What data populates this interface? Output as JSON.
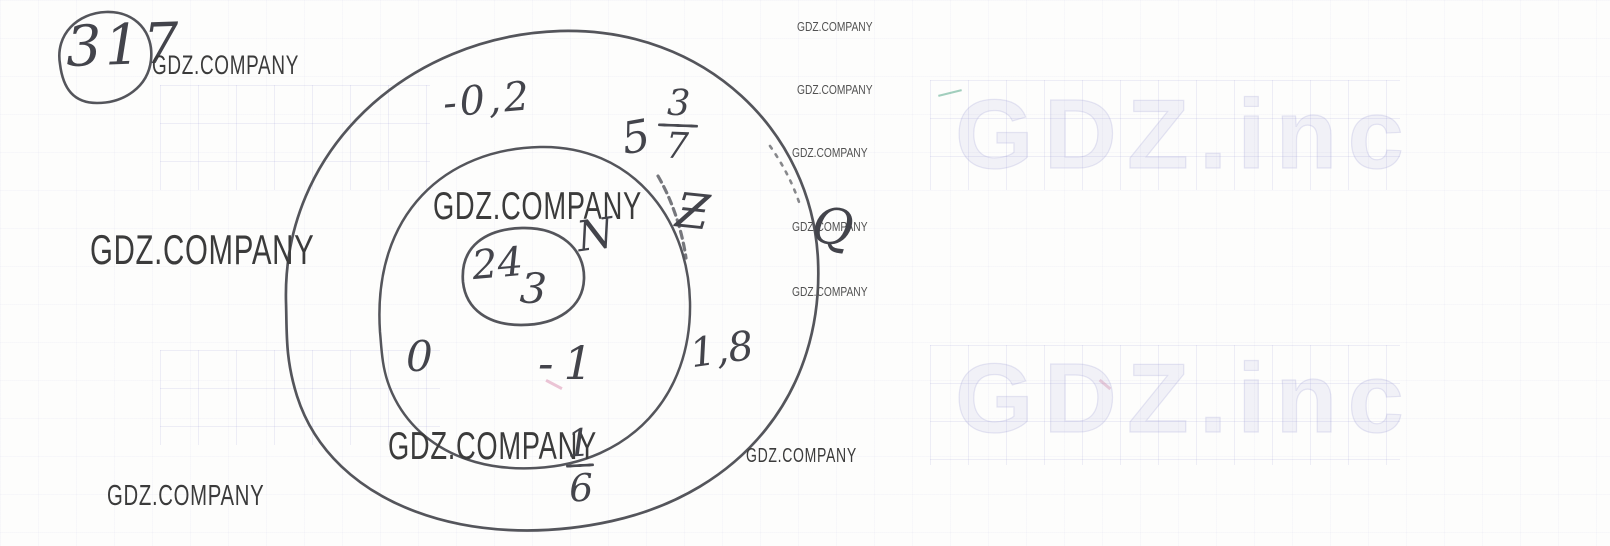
{
  "watermarks": {
    "brand": "GDZ.COMPANY",
    "faint_brand": "GDZ.inc"
  },
  "problem": {
    "number": "317"
  },
  "diagram": {
    "type": "euler-diagram-number-sets",
    "sets": {
      "natural": {
        "symbol": "N",
        "elements": {
          "e1": "24",
          "e2": "3"
        }
      },
      "integer": {
        "symbol": "Ƶ",
        "elements": {
          "e1": "0",
          "e2": "-1"
        }
      },
      "rational": {
        "symbol": "Q",
        "elements": {
          "neg_decimal": "-0,2",
          "mixed_whole": "5",
          "mixed_numerator": "3",
          "mixed_denominator": "7",
          "pos_decimal": "1,8",
          "frac_numerator": "1",
          "frac_denominator": "6"
        }
      }
    }
  }
}
